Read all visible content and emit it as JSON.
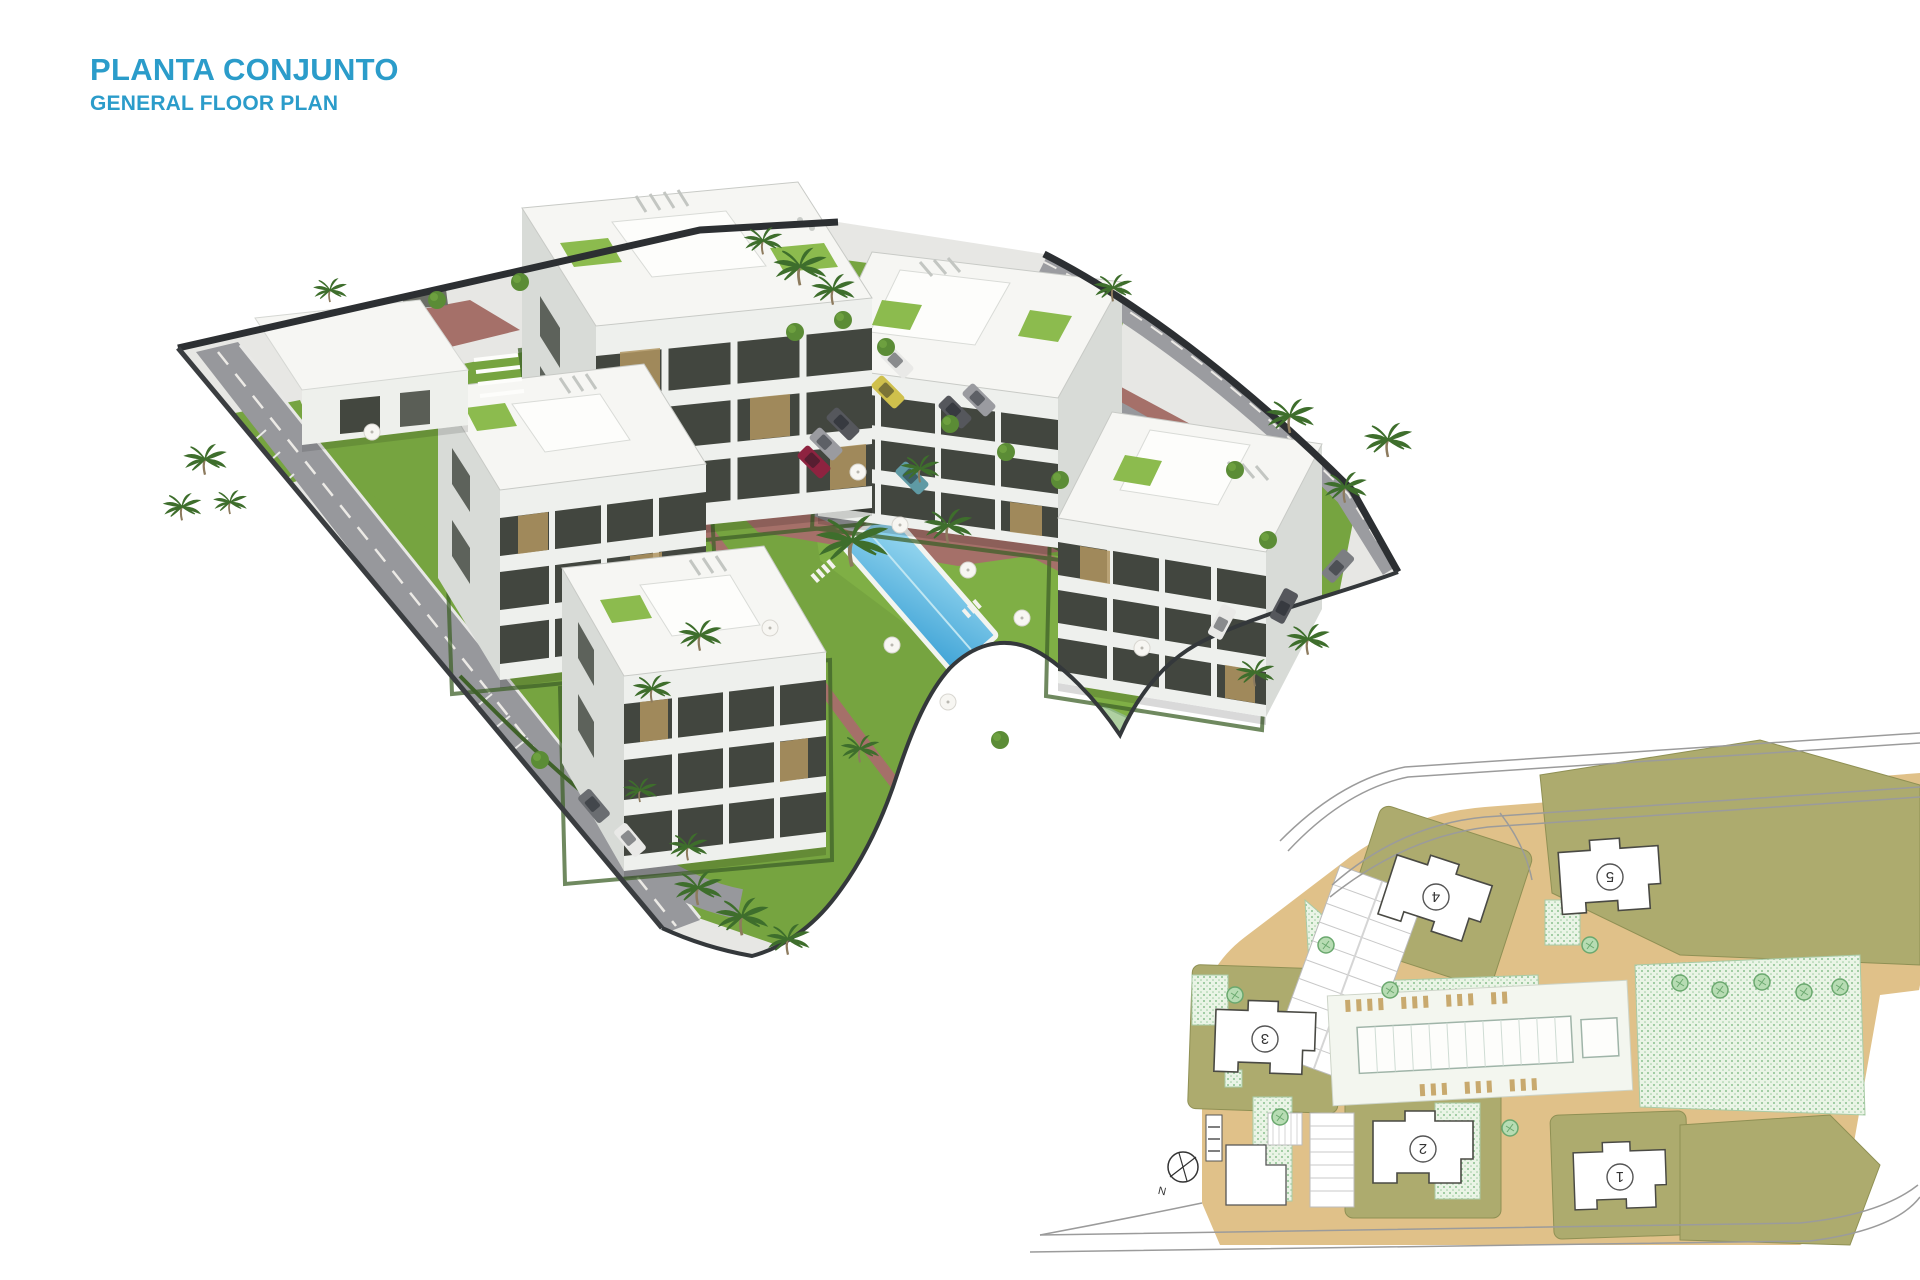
{
  "header": {
    "title": "PLANTA CONJUNTO",
    "subtitle": "GENERAL FLOOR PLAN",
    "accent_color": "#2B9CCA"
  },
  "inset": {
    "buildings": [
      {
        "label": "1"
      },
      {
        "label": "2"
      },
      {
        "label": "3"
      },
      {
        "label": "4"
      },
      {
        "label": "5"
      }
    ],
    "compass": {
      "label": "N",
      "icon": "north-arrow-icon"
    }
  },
  "palette": {
    "pool_blue": "#4FA9D8",
    "grass_green": "#76A440",
    "brick_path": "#A57069",
    "road_gray": "#97989C",
    "site_tan": "#E0C189",
    "plot_olive": "#ADAB6E",
    "building_white": "#F4F5F2",
    "dark_edge": "#2C2F32",
    "playground_green": "#AFD0A2"
  }
}
